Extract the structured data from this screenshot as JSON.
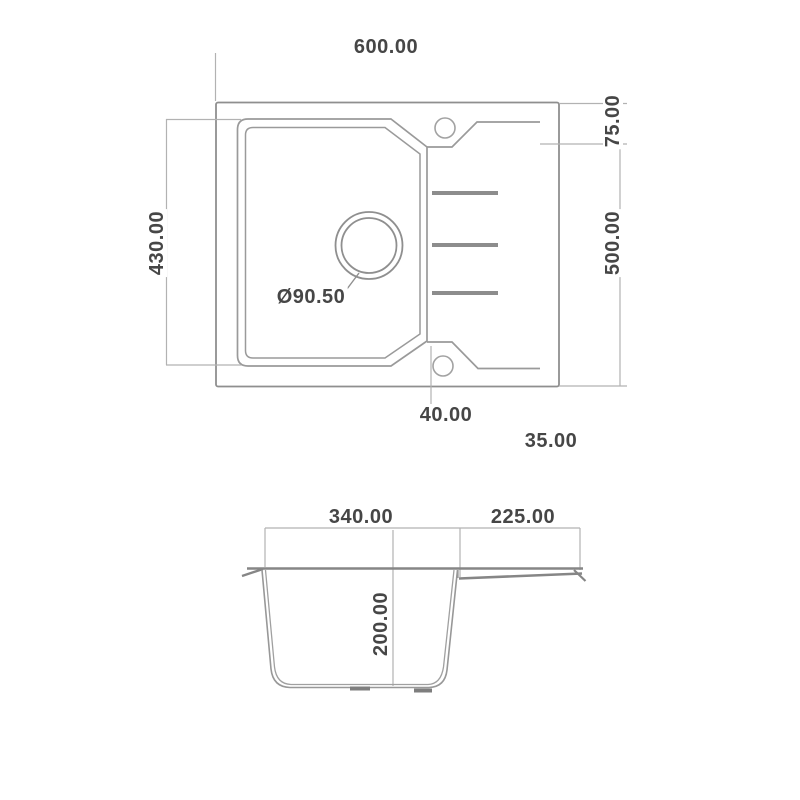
{
  "drawing_title": "sink-technical-drawing",
  "colors": {
    "background": "#ffffff",
    "outline": "#8f8f8f",
    "thin_line": "#a9a9a9",
    "thick_line": "#868686",
    "rib": "#8d8d8d",
    "text": "#464646"
  },
  "top_view": {
    "overall_width": "600.00",
    "overall_depth": "500.00",
    "bowl_depth": "430.00",
    "rim_top_offset": "75.00",
    "drain_diameter": "Ø90.50",
    "wing_bottom_offset": "40.00",
    "edge_offset": "35.00"
  },
  "section_view": {
    "bowl_width": "340.00",
    "drainer_width": "225.00",
    "bowl_height": "200.00"
  }
}
